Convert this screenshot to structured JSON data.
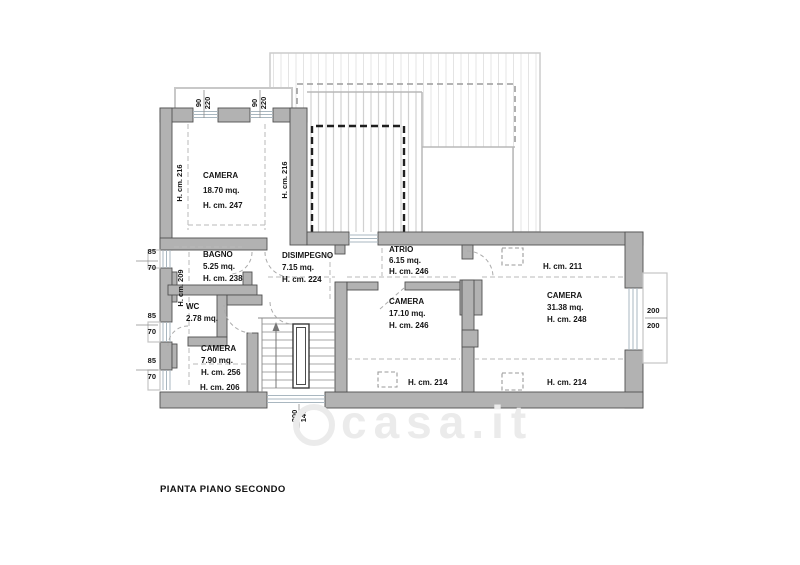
{
  "title": "PIANTA PIANO SECONDO",
  "watermark": "casa.it",
  "rooms": {
    "camera1": {
      "name": "CAMERA",
      "area": "18.70 mq.",
      "height": "H. cm. 247"
    },
    "bagno": {
      "name": "BAGNO",
      "area": "5.25 mq.",
      "height": "H. cm. 238"
    },
    "wc": {
      "name": "WC",
      "area": "2.78 mq."
    },
    "disimpegno": {
      "name": "DISIMPEGNO",
      "area": "7.15 mq.",
      "height": "H. cm. 224"
    },
    "camera2": {
      "name": "CAMERA",
      "area": "7.90 mq.",
      "height": "H. cm. 256",
      "height_low": "H. cm. 206"
    },
    "atrio": {
      "name": "ATRIO",
      "area": "6.15 mq.",
      "height": "H. cm. 246"
    },
    "camera3": {
      "name": "CAMERA",
      "area": "17.10 mq.",
      "height": "H. cm. 246",
      "height_low": "H. cm. 214"
    },
    "camera4": {
      "name": "CAMERA",
      "area": "31.38 mq.",
      "height": "H. cm. 248",
      "height_top": "H. cm. 211",
      "height_low": "H. cm. 214"
    }
  },
  "wall_heights": {
    "left_room_west": "H. cm. 216",
    "left_room_east": "H. cm. 216",
    "wc_wall": "H. cm. 209"
  },
  "dims": {
    "top_win1_w": "90",
    "top_win1_h": "220",
    "top_win2_w": "90",
    "top_win2_h": "220",
    "left_win1_w": "85",
    "left_win1_h": "70",
    "left_win2_w": "85",
    "left_win2_h": "70",
    "left_win3_w": "85",
    "left_win3_h": "70",
    "right_win_w": "200",
    "right_win_h": "200",
    "stair_win_w": "200",
    "stair_win_h": "140"
  }
}
